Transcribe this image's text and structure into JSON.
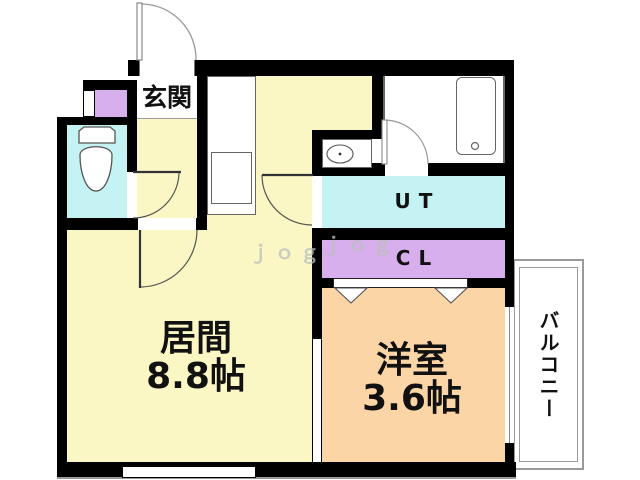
{
  "plan_title": "1LDK floor plan",
  "rooms": {
    "genkan": {
      "label": "玄関"
    },
    "living": {
      "name": "居間",
      "size": "8.8帖"
    },
    "western": {
      "name": "洋室",
      "size": "3.6帖"
    },
    "utility": {
      "label": "UT"
    },
    "closet": {
      "label": "CL"
    },
    "balcony": {
      "label": "バルコニー"
    }
  },
  "watermark": {
    "text": "ｊｏｇ"
  },
  "colors": {
    "floor-yellow": "#FAF7C5",
    "floor-cyan": "#C5F2F2",
    "floor-purple": "#D7AFEC",
    "floor-orange": "#FBD5A5",
    "wall": "#000000",
    "fixture-line": "#666666",
    "door-line": "#555555",
    "arc-light": "#999999",
    "balcony-line": "#9A9A9A",
    "text": "#111111",
    "watermark": "#BDBDBD"
  }
}
